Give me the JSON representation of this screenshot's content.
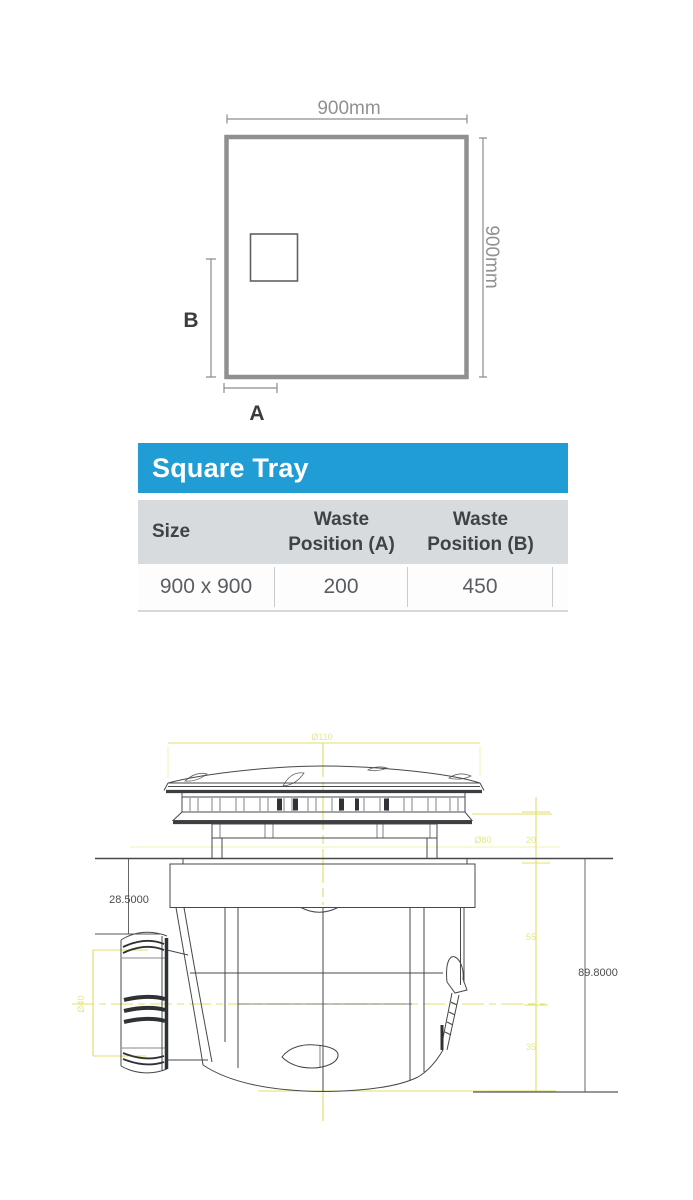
{
  "tray_diagram": {
    "width_label": "900mm",
    "height_label": "900mm",
    "label_a": "A",
    "label_b": "B"
  },
  "spec_table": {
    "title": "Square Tray",
    "col_size": "Size",
    "col_waste_a_line1": "Waste",
    "col_waste_a_line2": "Position (A)",
    "col_waste_b_line1": "Waste",
    "col_waste_b_line2": "Position (B)",
    "row": {
      "size": "900 x 900",
      "waste_a": "200",
      "waste_b": "450"
    },
    "colors": {
      "header_blue": "#1F9DD4",
      "band_gray": "#D8DBDE"
    }
  },
  "waste_drawing": {
    "dim_height_left": "28.5000",
    "dim_height_right": "89.8000",
    "dim_top_diameter": "Ø110",
    "dim_mid_diameter": "Ø80",
    "dim_outlet_diameter": "Ø40",
    "dim_seg_top": "20",
    "dim_seg_mid": "55",
    "dim_seg_bottom": "35",
    "accent_yellow": "#DCDC4E"
  }
}
